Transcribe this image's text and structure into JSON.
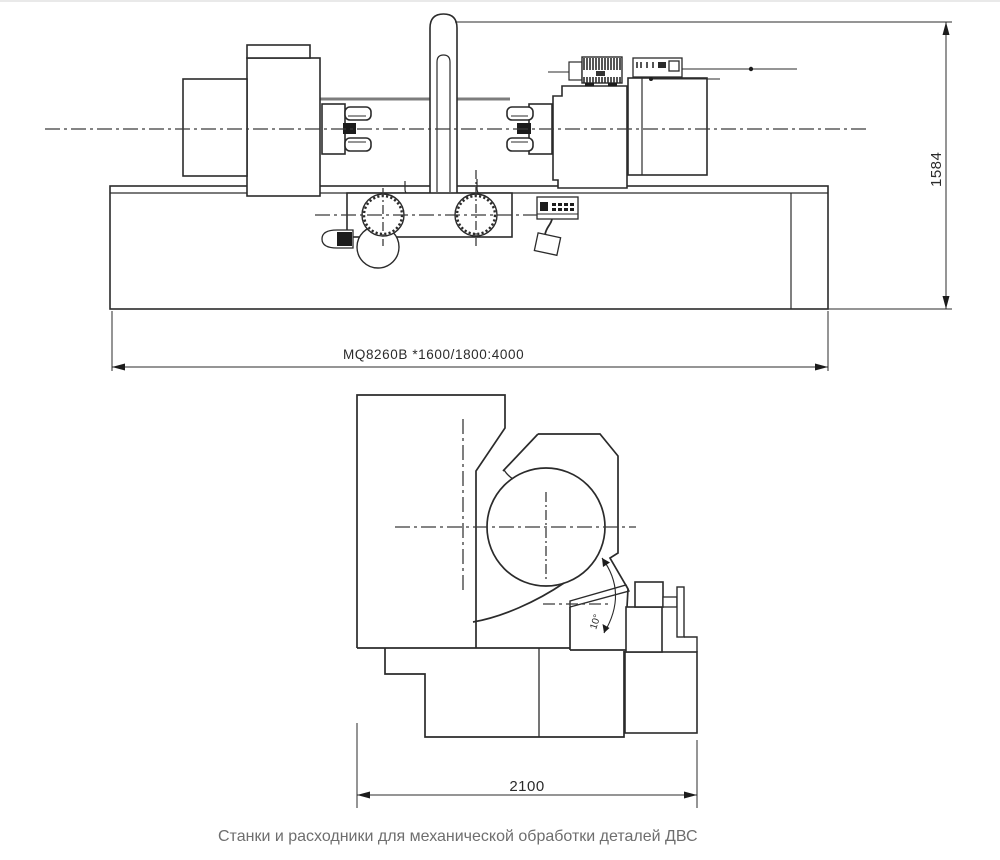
{
  "drawing": {
    "type": "engineering-two-view-drawing",
    "subject": "crankshaft grinding machine",
    "front_view_bottom_label": "MQ8260B *1600/1800:4000",
    "height_dimension": "1584",
    "width_dimension": "2100",
    "angle_dimension": "10°"
  },
  "caption": "Станки и расходники для механической обработки деталей ДВС",
  "colors": {
    "line": "#2b2b2b",
    "way_line": "#7d7d7d",
    "caption_text": "#6e6e6e",
    "background": "#ffffff"
  }
}
